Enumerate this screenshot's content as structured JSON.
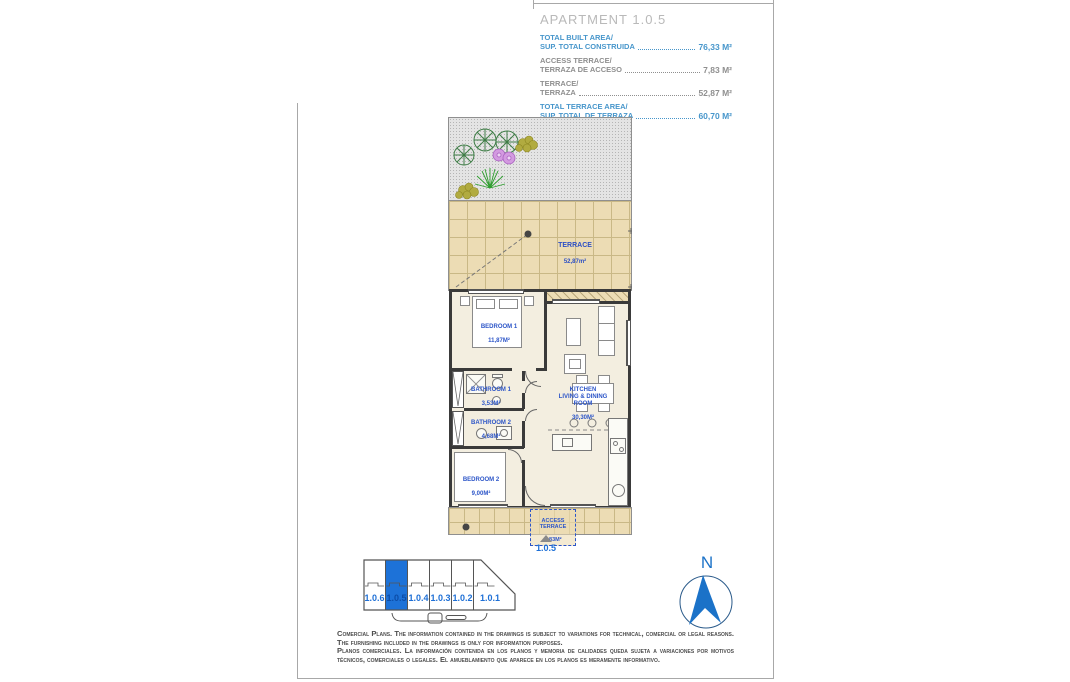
{
  "info": {
    "title": "APARTMENT 1.0.5",
    "rows": [
      {
        "l1": "TOTAL BUILT AREA/",
        "l2": "SUP. TOTAL CONSTRUIDA",
        "value": "76,33 M²",
        "tone": "blue"
      },
      {
        "l1": "ACCESS TERRACE/",
        "l2": "TERRAZA DE ACCESO",
        "value": "7,83 M²",
        "tone": "gray"
      },
      {
        "l1": "TERRACE/",
        "l2": "TERRAZA",
        "value": "52,87 M²",
        "tone": "gray"
      },
      {
        "l1": "TOTAL TERRACE AREA/",
        "l2": "SUP. TOTAL DE TERRAZA",
        "value": "60,70 M²",
        "tone": "blue"
      }
    ]
  },
  "plan": {
    "rooms": {
      "terrace": {
        "name": "TERRACE",
        "area": "52,87m²"
      },
      "bedroom1": {
        "name": "BEDROOM 1",
        "area": "11,87M²"
      },
      "bathroom1": {
        "name": "BATHROOM 1",
        "area": "3,53M²"
      },
      "bathroom2": {
        "name": "BATHROOM 2",
        "area": "4,68M²"
      },
      "bedroom2": {
        "name": "BEDROOM 2",
        "area": "9,00M²"
      },
      "kitchen": {
        "name": "KITCHEN\nLIVING & DINING\nROOM",
        "area": "30,30M²"
      },
      "access": {
        "name": "ACCESS\nTERRACE",
        "area": "7,83M²"
      }
    },
    "unit_marker": "1.0.5"
  },
  "key_plan": {
    "units": [
      "1.0.6",
      "1.0.5",
      "1.0.4",
      "1.0.3",
      "1.0.2",
      "1.0.1"
    ],
    "selected": "1.0.5",
    "highlight_color": "#1d72d8"
  },
  "compass": {
    "north": "N"
  },
  "disclaimer": {
    "en": "Comercial Plans. The information contained in the drawings is subject to variations for technical, comercial or legal reasons. The furnishing included in the drawings is only for information purposes.",
    "es": "Planos comerciales. La información contenida en los planos y memoria de calidades queda sujeta a variaciones por motivos técnicos, comerciales o legales. El amueblamiento que aparece en los planos es meramente informativo."
  },
  "colors": {
    "accent_blue": "#1d6fd6",
    "value_blue": "#4796cb",
    "label_gray": "#8f8f8f",
    "plan_label_blue": "#2c55c8",
    "terrace_tan": "#ecdcb4",
    "wall": "#3a3a3a"
  }
}
